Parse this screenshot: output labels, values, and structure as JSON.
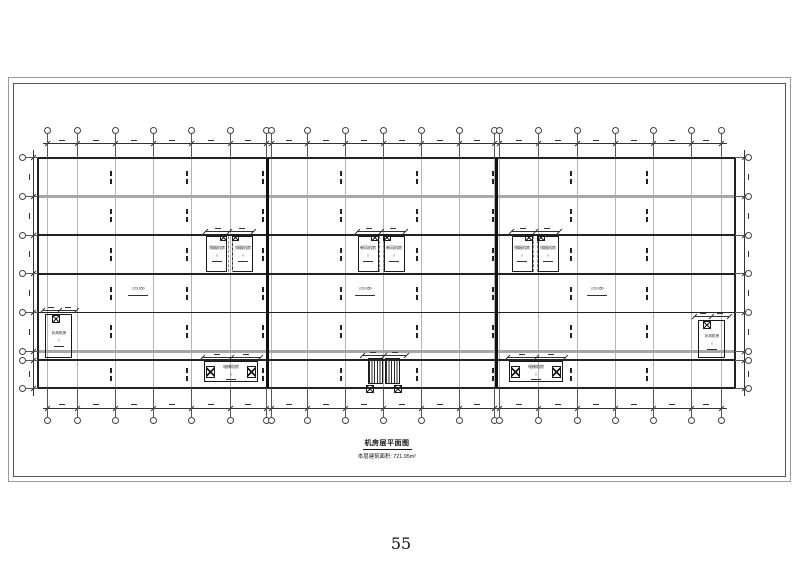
{
  "page": {
    "number": "55",
    "background": "#ffffff"
  },
  "title_block": {
    "title": "机房层平面图",
    "area_note": "本层建筑面积: 721.95m²"
  },
  "glyphs": {
    "level_mark": "▽"
  },
  "colors": {
    "wall": "#222222",
    "line": "#1a1a1a",
    "gray_band": "#a8a8a8",
    "grid": "rgba(120,120,120,0.55)",
    "dim": "#333333",
    "bubble": "#444444"
  },
  "plan": {
    "grid_columns": [
      47,
      77,
      115,
      153,
      191,
      230,
      266.5,
      271.5,
      307,
      345,
      383,
      421,
      459,
      494.5,
      499.5,
      538,
      577,
      615,
      653,
      691,
      721
    ],
    "grid_rows": [
      157.5,
      196,
      235,
      273.5,
      312,
      351.5,
      360,
      388
    ],
    "top_bubble_y": 130,
    "bottom_bubble_y": 420.5,
    "left_bubble_x": 22,
    "right_bubble_x": 748,
    "wall_left": 38,
    "wall_right": 735,
    "wall_top": 157.5,
    "wall_bottom": 388,
    "h_lines": [
      {
        "y": 157.5,
        "t": 2,
        "c": "wall"
      },
      {
        "y": 196,
        "t": 3,
        "c": "gray"
      },
      {
        "y": 235,
        "t": 1.5,
        "c": "wall"
      },
      {
        "y": 273.5,
        "t": 2,
        "c": "wall"
      },
      {
        "y": 312,
        "t": 1,
        "c": "wall"
      },
      {
        "y": 351.5,
        "t": 3,
        "c": "gray"
      },
      {
        "y": 360,
        "t": 1.5,
        "c": "wall"
      },
      {
        "y": 388,
        "t": 2,
        "c": "wall"
      }
    ],
    "v_joints": [
      267.5,
      496.5
    ],
    "dim": {
      "top_y": 143.5,
      "bottom_y": 408,
      "left_x": 33,
      "right_x": 744
    },
    "ibar_columns": [
      111,
      187,
      263,
      341,
      417,
      493,
      571,
      647
    ],
    "ibar_row_centers": [
      177,
      215.5,
      254,
      293,
      331.5,
      374
    ],
    "level_markers": [
      {
        "x": 128,
        "y": 289,
        "value": "23.950"
      },
      {
        "x": 355,
        "y": 289,
        "value": "23.950"
      },
      {
        "x": 587,
        "y": 289,
        "value": "23.950"
      }
    ],
    "fan_room_pairs": [
      {
        "cx": 229.5,
        "label": "排烟机房"
      },
      {
        "cx": 381,
        "label": "新风机房"
      },
      {
        "cx": 535,
        "label": "排烟机房"
      }
    ],
    "edge_rooms": [
      {
        "x": 45,
        "y": 314,
        "w": 27,
        "h": 44,
        "label": "补风机房",
        "fan": [
          56,
          319
        ],
        "dim": [
          42,
          76,
          310
        ]
      },
      {
        "x": 698,
        "y": 320,
        "w": 27,
        "h": 38,
        "label": "补风机房",
        "fan": [
          707,
          325
        ],
        "dim": [
          694,
          729,
          316
        ]
      }
    ],
    "machine_rooms": [
      {
        "cx": 231,
        "label": "电梯机房"
      },
      {
        "cx": 536,
        "label": "电梯机房"
      }
    ],
    "stair": {
      "cx": 384,
      "y": 358,
      "box_w": 15,
      "box_h": 26
    }
  }
}
